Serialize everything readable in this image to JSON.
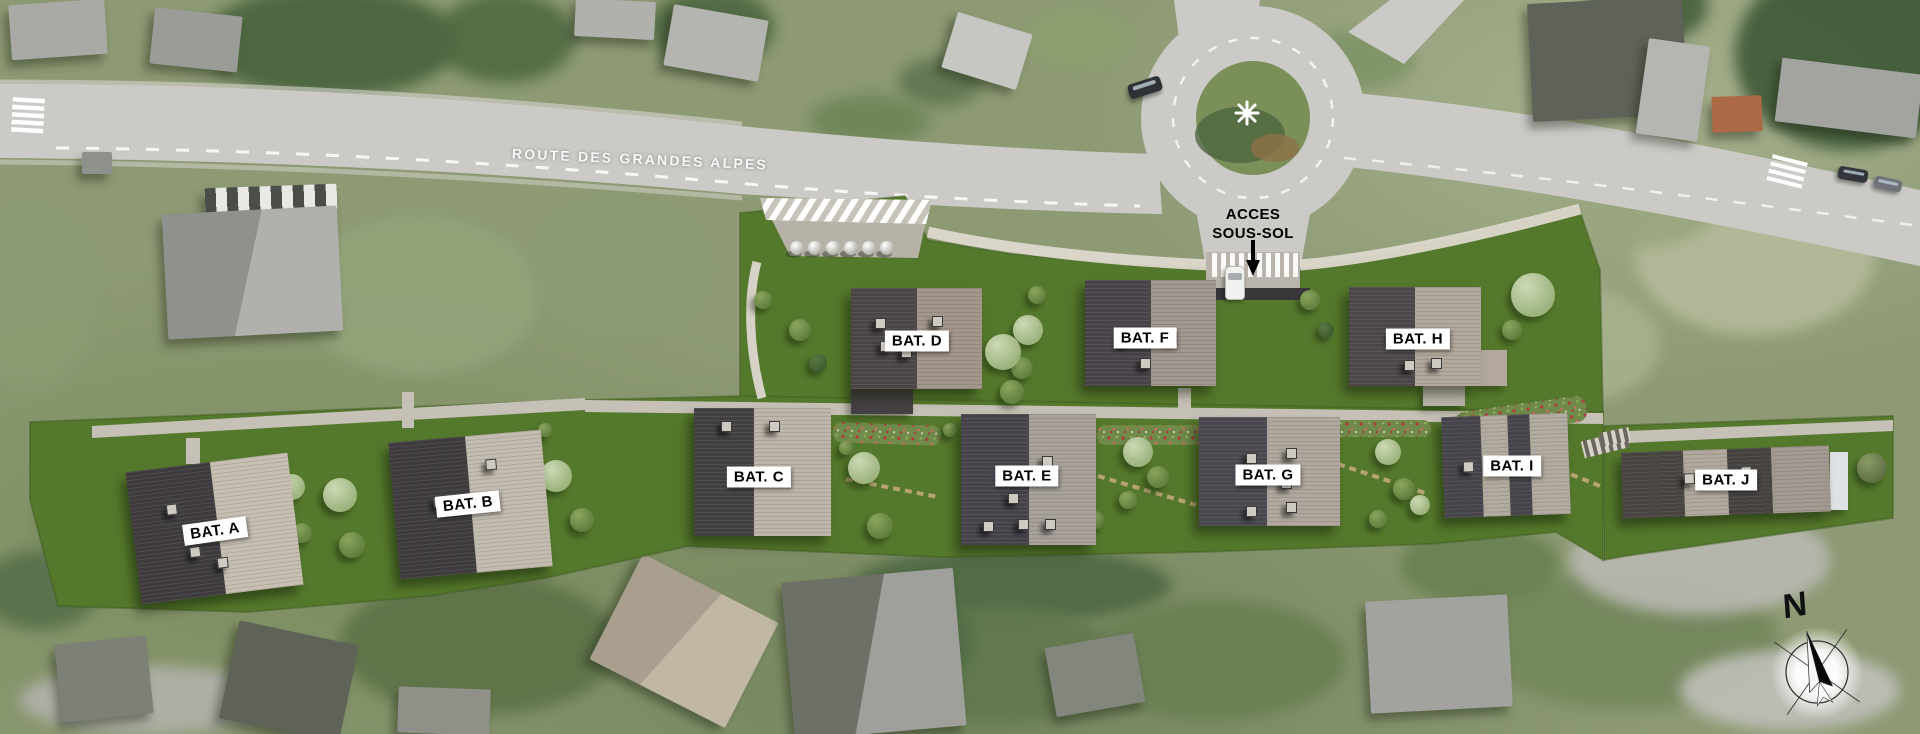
{
  "canvas": {
    "width": 1920,
    "height": 734
  },
  "colors": {
    "photo_base": "#8d9a74",
    "photo_road": "#cbcac6",
    "site_grass": "#55792c",
    "site_path": "#c6c1b7",
    "roof_dark": "#413e40",
    "roof_light": "#c0b9ad",
    "label_bg": "#ffffff",
    "label_text": "#000000"
  },
  "site": {
    "road_label": "ROUTE DES GRANDES ALPES",
    "access_label_line1": "ACCES",
    "access_label_line2": "SOUS-SOL",
    "compass": {
      "label": "N",
      "x": 1817,
      "y": 672
    },
    "buildings": [
      {
        "id": "A",
        "label": "BAT. A",
        "x": 133,
        "y": 462,
        "w": 163,
        "h": 133,
        "rot": -7,
        "lx": 215,
        "ly": 531,
        "lrot": -8,
        "bands": [
          {
            "w": 0.52,
            "c": "#3e3b3e"
          },
          {
            "w": 0.48,
            "c": "#c6bfb2"
          }
        ],
        "vents": [
          [
            0.22,
            0.28
          ],
          [
            0.33,
            0.62
          ],
          [
            0.49,
            0.72
          ]
        ]
      },
      {
        "id": "B",
        "label": "BAT. B",
        "x": 394,
        "y": 436,
        "w": 153,
        "h": 137,
        "rot": -5,
        "lx": 468,
        "ly": 504,
        "lrot": -6,
        "bands": [
          {
            "w": 0.5,
            "c": "#3e3b3e"
          },
          {
            "w": 0.5,
            "c": "#c3bcb0"
          }
        ],
        "vents": [
          [
            0.26,
            0.42
          ],
          [
            0.62,
            0.18
          ]
        ]
      },
      {
        "id": "C",
        "label": "BAT. C",
        "x": 694,
        "y": 408,
        "w": 137,
        "h": 128,
        "rot": 0,
        "lx": 759,
        "ly": 477,
        "lrot": 0,
        "bands": [
          {
            "w": 0.44,
            "c": "#423f41"
          },
          {
            "w": 0.56,
            "c": "#bdb5a9"
          }
        ],
        "vents": [
          [
            0.2,
            0.1
          ],
          [
            0.55,
            0.1
          ]
        ]
      },
      {
        "id": "D",
        "label": "BAT. D",
        "x": 851,
        "y": 288,
        "w": 131,
        "h": 101,
        "rot": 0,
        "lx": 917,
        "ly": 341,
        "lrot": 0,
        "bands": [
          {
            "w": 0.5,
            "c": "#4a4547"
          },
          {
            "w": 0.5,
            "c": "#a3978b"
          }
        ],
        "vents": [
          [
            0.18,
            0.3
          ],
          [
            0.62,
            0.28
          ],
          [
            0.38,
            0.58
          ],
          [
            0.22,
            0.52
          ]
        ]
      },
      {
        "id": "E",
        "label": "BAT. E",
        "x": 961,
        "y": 414,
        "w": 135,
        "h": 131,
        "rot": 0,
        "lx": 1027,
        "ly": 476,
        "lrot": 0,
        "bands": [
          {
            "w": 0.5,
            "c": "#45424a"
          },
          {
            "w": 0.5,
            "c": "#a8a29b"
          }
        ],
        "vents": [
          [
            0.6,
            0.32
          ],
          [
            0.35,
            0.6
          ],
          [
            0.42,
            0.8
          ],
          [
            0.16,
            0.82
          ],
          [
            0.62,
            0.8
          ]
        ]
      },
      {
        "id": "F",
        "label": "BAT. F",
        "x": 1085,
        "y": 280,
        "w": 131,
        "h": 106,
        "rot": 0,
        "lx": 1145,
        "ly": 338,
        "lrot": 0,
        "bands": [
          {
            "w": 0.5,
            "c": "#484349"
          },
          {
            "w": 0.5,
            "c": "#a29a90"
          }
        ],
        "vents": [
          [
            0.26,
            0.52
          ],
          [
            0.62,
            0.5
          ],
          [
            0.42,
            0.74
          ]
        ]
      },
      {
        "id": "G",
        "label": "BAT. G",
        "x": 1199,
        "y": 417,
        "w": 141,
        "h": 109,
        "rot": 0,
        "lx": 1268,
        "ly": 475,
        "lrot": 0,
        "bands": [
          {
            "w": 0.48,
            "c": "#4a474e"
          },
          {
            "w": 0.52,
            "c": "#b0a89e"
          }
        ],
        "vents": [
          [
            0.33,
            0.33
          ],
          [
            0.62,
            0.28
          ],
          [
            0.58,
            0.56
          ],
          [
            0.33,
            0.82
          ],
          [
            0.62,
            0.78
          ]
        ]
      },
      {
        "id": "H",
        "label": "BAT. H",
        "x": 1349,
        "y": 287,
        "w": 132,
        "h": 99,
        "rot": 0,
        "lx": 1418,
        "ly": 339,
        "lrot": 0,
        "bands": [
          {
            "w": 0.5,
            "c": "#4c4648"
          },
          {
            "w": 0.5,
            "c": "#b2a89b"
          }
        ],
        "vents": [
          [
            0.3,
            0.45
          ],
          [
            0.6,
            0.42
          ],
          [
            0.42,
            0.74
          ],
          [
            0.62,
            0.72
          ]
        ]
      },
      {
        "id": "I",
        "label": "BAT. I",
        "x": 1443,
        "y": 415,
        "w": 126,
        "h": 101,
        "rot": -2,
        "lx": 1512,
        "ly": 466,
        "lrot": 0,
        "bands": [
          {
            "w": 0.31,
            "c": "#46434a"
          },
          {
            "w": 0.21,
            "c": "#b2aba0"
          },
          {
            "w": 0.18,
            "c": "#46434a"
          },
          {
            "w": 0.3,
            "c": "#b2aba0"
          }
        ],
        "vents": [
          [
            0.16,
            0.45
          ],
          [
            0.48,
            0.42
          ]
        ]
      },
      {
        "id": "J",
        "label": "BAT. J",
        "x": 1622,
        "y": 449,
        "w": 208,
        "h": 66,
        "rot": -2,
        "lx": 1726,
        "ly": 480,
        "lrot": 0,
        "bands": [
          {
            "w": 0.3,
            "c": "#474340"
          },
          {
            "w": 0.21,
            "c": "#b1a89e"
          },
          {
            "w": 0.21,
            "c": "#44413f"
          },
          {
            "w": 0.28,
            "c": "#a39a91"
          }
        ],
        "vents": [
          [
            0.3,
            0.35
          ],
          [
            0.57,
            0.28
          ]
        ]
      }
    ],
    "wings": [
      {
        "x": 851,
        "y": 389,
        "w": 62,
        "h": 25,
        "c": "#444043"
      },
      {
        "x": 1423,
        "y": 386,
        "w": 42,
        "h": 20,
        "c": "#b7b2a8"
      },
      {
        "x": 1481,
        "y": 350,
        "w": 26,
        "h": 36,
        "c": "#b2a89b"
      },
      {
        "x": 1830,
        "y": 452,
        "w": 18,
        "h": 58,
        "c": "#dfe2e4"
      }
    ],
    "trees": [
      [
        292,
        487,
        13,
        "pale"
      ],
      [
        340,
        495,
        17,
        "pale"
      ],
      [
        352,
        545,
        13,
        "mid"
      ],
      [
        302,
        533,
        10,
        "mid"
      ],
      [
        556,
        476,
        16,
        "pale"
      ],
      [
        582,
        520,
        12,
        "mid"
      ],
      [
        545,
        430,
        7,
        "mid"
      ],
      [
        864,
        468,
        16,
        "pale"
      ],
      [
        880,
        526,
        13,
        "mid"
      ],
      [
        846,
        448,
        7,
        "mid"
      ],
      [
        800,
        330,
        11,
        "mid"
      ],
      [
        818,
        363,
        9,
        "dark"
      ],
      [
        763,
        300,
        9,
        "mid"
      ],
      [
        1028,
        330,
        15,
        "pale"
      ],
      [
        1037,
        295,
        9,
        "mid"
      ],
      [
        1022,
        368,
        11,
        "mid"
      ],
      [
        1003,
        352,
        18,
        "pale"
      ],
      [
        1012,
        392,
        12,
        "mid"
      ],
      [
        950,
        430,
        7,
        "mid"
      ],
      [
        1138,
        452,
        15,
        "pale"
      ],
      [
        1158,
        477,
        11,
        "mid"
      ],
      [
        1128,
        500,
        9,
        "mid"
      ],
      [
        1095,
        520,
        9,
        "mid"
      ],
      [
        1310,
        300,
        10,
        "mid"
      ],
      [
        1326,
        330,
        8,
        "dark"
      ],
      [
        1388,
        452,
        13,
        "pale"
      ],
      [
        1404,
        489,
        11,
        "mid"
      ],
      [
        1378,
        519,
        9,
        "mid"
      ],
      [
        1533,
        295,
        22,
        "pale"
      ],
      [
        1512,
        330,
        10,
        "mid"
      ],
      [
        1420,
        505,
        10,
        "pale"
      ],
      [
        1872,
        468,
        15,
        "olive"
      ]
    ],
    "spheres": {
      "count": 6,
      "x_start": 797,
      "spacing": 18,
      "y": 248,
      "r": 7
    },
    "render_car": {
      "x": 1235,
      "y": 266,
      "w": 20,
      "h": 34
    }
  },
  "photo": {
    "blobs": [
      [
        330,
        42,
        130,
        55,
        "#47633c"
      ],
      [
        505,
        38,
        70,
        45,
        "#4f6a42"
      ],
      [
        712,
        28,
        62,
        40,
        "#4c6740"
      ],
      [
        940,
        82,
        42,
        24,
        "#5f7550"
      ],
      [
        1078,
        38,
        52,
        30,
        "#8da06f"
      ],
      [
        1850,
        55,
        115,
        95,
        "#3e5937"
      ],
      [
        1648,
        6,
        60,
        38,
        "#46613c"
      ],
      [
        95,
        128,
        70,
        16,
        "#5d7349"
      ],
      [
        268,
        140,
        85,
        15,
        "#647a50"
      ],
      [
        30,
        300,
        70,
        90,
        "#8b9b72"
      ],
      [
        420,
        295,
        120,
        80,
        "#93a37a"
      ],
      [
        620,
        268,
        90,
        70,
        "#8c9c74"
      ],
      [
        120,
        520,
        90,
        60,
        "#7b8c60"
      ],
      [
        480,
        645,
        140,
        70,
        "#5d7248"
      ],
      [
        1012,
        585,
        160,
        38,
        "#4e6943"
      ],
      [
        1000,
        665,
        120,
        60,
        "#61784f"
      ],
      [
        1215,
        660,
        130,
        60,
        "#697e52"
      ],
      [
        1628,
        640,
        150,
        70,
        "#74875c"
      ],
      [
        1480,
        565,
        80,
        40,
        "#688050"
      ],
      [
        1755,
        255,
        120,
        80,
        "#b4ba9a"
      ],
      [
        1565,
        345,
        95,
        60,
        "#a8b18e"
      ],
      [
        1642,
        198,
        80,
        50,
        "#9aa67f"
      ],
      [
        1700,
        560,
        130,
        55,
        "#b9b9b2"
      ],
      [
        1790,
        690,
        110,
        40,
        "#c0c0ba"
      ],
      [
        150,
        700,
        130,
        34,
        "#b2b2ab"
      ],
      [
        40,
        590,
        60,
        40,
        "#57704a"
      ],
      [
        560,
        520,
        55,
        35,
        "#4f6a42"
      ],
      [
        905,
        640,
        70,
        50,
        "#526e47"
      ],
      [
        1355,
        60,
        60,
        30,
        "#7f9468"
      ],
      [
        870,
        120,
        60,
        25,
        "#6d8458"
      ]
    ],
    "houses": [
      {
        "x": 10,
        "y": 2,
        "w": 96,
        "h": 55,
        "rot": -4,
        "c": "#a9aaa5"
      },
      {
        "x": 152,
        "y": 12,
        "w": 88,
        "h": 56,
        "rot": 6,
        "c": "#9b9c97"
      },
      {
        "x": 205,
        "y": 186,
        "w": 132,
        "h": 26,
        "rot": -2,
        "c": "#8e918c",
        "awning": true
      },
      {
        "x": 165,
        "y": 210,
        "w": 175,
        "h": 125,
        "rot": -3,
        "c": "#b0b1ac",
        "c2": "#8f918c"
      },
      {
        "x": 82,
        "y": 152,
        "w": 30,
        "h": 22,
        "rot": 0,
        "c": "#8e918c"
      },
      {
        "x": 575,
        "y": 0,
        "w": 80,
        "h": 38,
        "rot": 3,
        "c": "#b0b1ac"
      },
      {
        "x": 668,
        "y": 12,
        "w": 96,
        "h": 62,
        "rot": 10,
        "c": "#b4b5b0"
      },
      {
        "x": 948,
        "y": 22,
        "w": 78,
        "h": 58,
        "rot": 17,
        "c": "#c6c7c2"
      },
      {
        "x": 1530,
        "y": 0,
        "w": 155,
        "h": 118,
        "rot": -3,
        "c": "#5f6258"
      },
      {
        "x": 1642,
        "y": 42,
        "w": 62,
        "h": 96,
        "rot": 8,
        "c": "#b5b6b1"
      },
      {
        "x": 1712,
        "y": 96,
        "w": 50,
        "h": 36,
        "rot": -2,
        "c": "#ad6a46"
      },
      {
        "x": 1778,
        "y": 66,
        "w": 142,
        "h": 64,
        "rot": 7,
        "c": "#a3a4a0"
      },
      {
        "x": 608,
        "y": 582,
        "w": 152,
        "h": 118,
        "rot": 27,
        "c": "#c0b7a5",
        "c2": "#a89f8e"
      },
      {
        "x": 788,
        "y": 575,
        "w": 172,
        "h": 158,
        "rot": -5,
        "c": "#9fa09b",
        "c2": "#6d7066"
      },
      {
        "x": 1368,
        "y": 598,
        "w": 142,
        "h": 112,
        "rot": -3,
        "c": "#a2a39e"
      },
      {
        "x": 228,
        "y": 632,
        "w": 122,
        "h": 100,
        "rot": 12,
        "c": "#5f6357"
      },
      {
        "x": 58,
        "y": 640,
        "w": 92,
        "h": 78,
        "rot": -6,
        "c": "#7d8076"
      },
      {
        "x": 398,
        "y": 688,
        "w": 92,
        "h": 46,
        "rot": 2,
        "c": "#8f9088"
      },
      {
        "x": 1050,
        "y": 640,
        "w": 90,
        "h": 70,
        "rot": -10,
        "c": "#83867c"
      }
    ],
    "cars": [
      {
        "x": 1128,
        "y": 80,
        "w": 34,
        "h": 15,
        "rot": -18,
        "c": "#2e3234"
      },
      {
        "x": 1838,
        "y": 168,
        "w": 30,
        "h": 13,
        "rot": 10,
        "c": "#33363a"
      },
      {
        "x": 1874,
        "y": 178,
        "w": 28,
        "h": 12,
        "rot": 12,
        "c": "#70747a"
      }
    ]
  }
}
